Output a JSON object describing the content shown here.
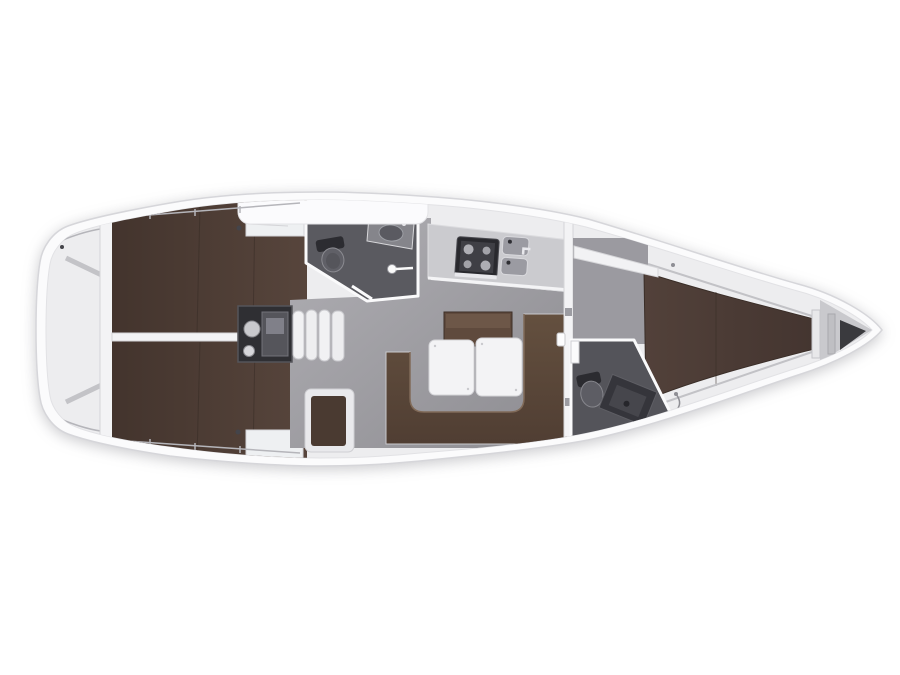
{
  "page": {
    "title": "Sailing yacht interior layout plan, top view, bow pointing right",
    "type": "floor-plan"
  },
  "colors": {
    "pageBg": "#ffffff",
    "hullOuter": "#fbfbfc",
    "hullStroke": "#d6d6da",
    "deck": "#ededef",
    "wall": "#f3f3f5",
    "whiteFurn": "#eef0f2",
    "furnStroke": "#d4d4d8",
    "floorLight": "#b0afb4",
    "floorDark": "#8d8c91",
    "berthDark": "#43342d",
    "berthLight": "#57453c",
    "vberthLight": "#52413a",
    "vberthDark": "#443530",
    "setteeLight": "#64503f",
    "setteeDark": "#503e33",
    "benchBrown": "#5f4a3d",
    "seatBrown": "#4a3a31",
    "bathFloor": "#5a5a60",
    "bathFloorFwd": "#54545a",
    "fixtureDark": "#35353b",
    "fixtureMid": "#74747a",
    "engineBg": "#2f2f33",
    "table": "#f3f3f5",
    "stove": "#29292e",
    "anchorLocker": "#3a3a3e"
  },
  "plan": {
    "orientation": "bow-right",
    "rooms": [
      {
        "id": "stern-platform",
        "label": "Stern transom and lazarette"
      },
      {
        "id": "aft-cabin-port",
        "label": "Aft double cabin, port side"
      },
      {
        "id": "aft-cabin-starboard",
        "label": "Aft double cabin, starboard side"
      },
      {
        "id": "engine-compartment",
        "label": "Engine compartment"
      },
      {
        "id": "companionway-steps",
        "label": "Companionway steps"
      },
      {
        "id": "aft-head",
        "label": "Aft head with toilet, basin and shower"
      },
      {
        "id": "galley",
        "label": "Galley with stove and twin sinks"
      },
      {
        "id": "salon",
        "label": "Salon with U-shaped settee and two-leaf table"
      },
      {
        "id": "nav-seat",
        "label": "Navigator seat module"
      },
      {
        "id": "forward-head",
        "label": "Forward head with toilet and vanity"
      },
      {
        "id": "forward-cabin",
        "label": "Forward cabin with V-berth"
      },
      {
        "id": "anchor-locker",
        "label": "Anchor locker at bow"
      }
    ]
  }
}
